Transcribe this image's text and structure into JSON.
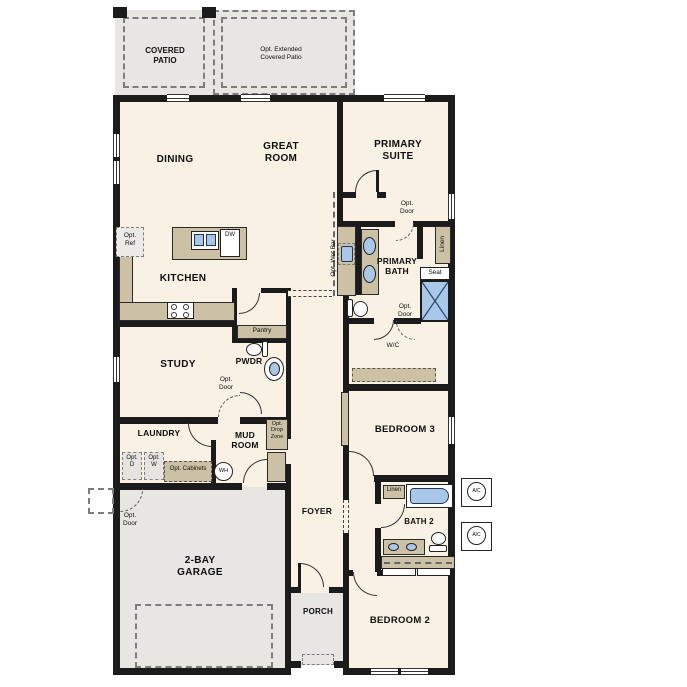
{
  "labels": {
    "covered_patio": "COVERED\nPATIO",
    "opt_extended_patio": "Opt. Extended\nCovered Patio",
    "dining": "DINING",
    "great_room": "GREAT\nROOM",
    "primary_suite": "PRIMARY\nSUITE",
    "opt_ref": "Opt.\nRef",
    "kitchen": "KITCHEN",
    "dw": "DW",
    "pantry": "Pantry",
    "opt_wet_bar": "Opt. Wet Bar",
    "primary_bath": "PRIMARY\nBATH",
    "linen": "Linen",
    "seat": "Seat",
    "opt_door": "Opt.\nDoor",
    "wc": "W/C",
    "pwdr": "PWDR",
    "study": "STUDY",
    "laundry": "LAUNDRY",
    "opt_d": "Opt.\nD",
    "opt_w": "Opt.\nW",
    "opt_cabinets": "Opt. Cabinets",
    "mud_room": "MUD\nROOM",
    "opt_drop_zone": "Opt.\nDrop\nZone",
    "wh": "WH",
    "foyer": "FOYER",
    "bedroom_3": "BEDROOM 3",
    "bath_2": "BATH 2",
    "ac": "A/C",
    "garage": "2-BAY\nGARAGE",
    "porch": "PORCH",
    "bedroom_2": "BEDROOM 2"
  },
  "colors": {
    "floor": "#f8f1e4",
    "hard": "#e7e6e3",
    "counter": "#cdc1a5",
    "fixture": "#a9c8e9",
    "wall": "#1b1b1b"
  }
}
